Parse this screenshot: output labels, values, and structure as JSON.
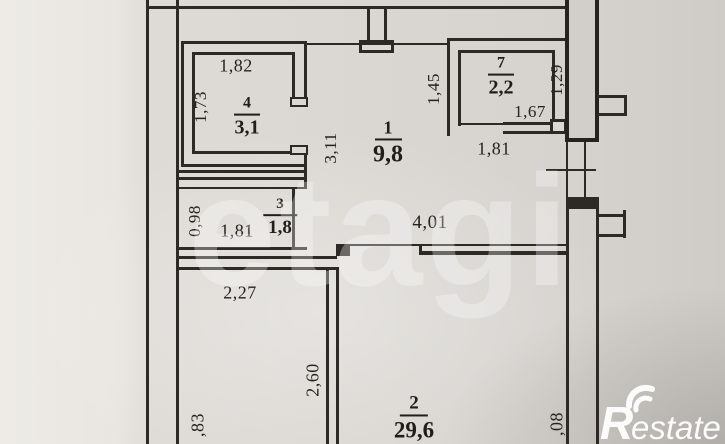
{
  "document": {
    "kind": "apartment floor plan photo"
  },
  "watermarks": {
    "etagi": "etagi",
    "restate_r": "R",
    "restate_suffix": "estate"
  },
  "rooms": {
    "r1": {
      "number": "1",
      "area": "9,8"
    },
    "r2": {
      "number": "2",
      "area": "29,6"
    },
    "r3": {
      "number": "3",
      "area": "1,8"
    },
    "r4": {
      "number": "4",
      "area": "3,1"
    },
    "r7": {
      "number": "7",
      "area": "2,2"
    }
  },
  "dimensions": {
    "r4_width_top": "1,82",
    "r4_height_left": "1,73",
    "r1_height_left": "3,11",
    "r7_height_left": "1,45",
    "r7_height_right": "1,29",
    "r7_width_bottom_inner": "1,67",
    "r7_width_bottom_outer": "1,81",
    "r3_height_left": "0,98",
    "r3_width_inner": "1,81",
    "corridor_width": "4,01",
    "lower_room_width": "2,27",
    "lower_room_height": "2,60",
    "edge_bottom_left": ",83",
    "edge_bottom_right": ",08"
  },
  "colors": {
    "ink": "#2d2a26",
    "paper": "#dad7d2",
    "watermark_white": "#ffffff"
  }
}
